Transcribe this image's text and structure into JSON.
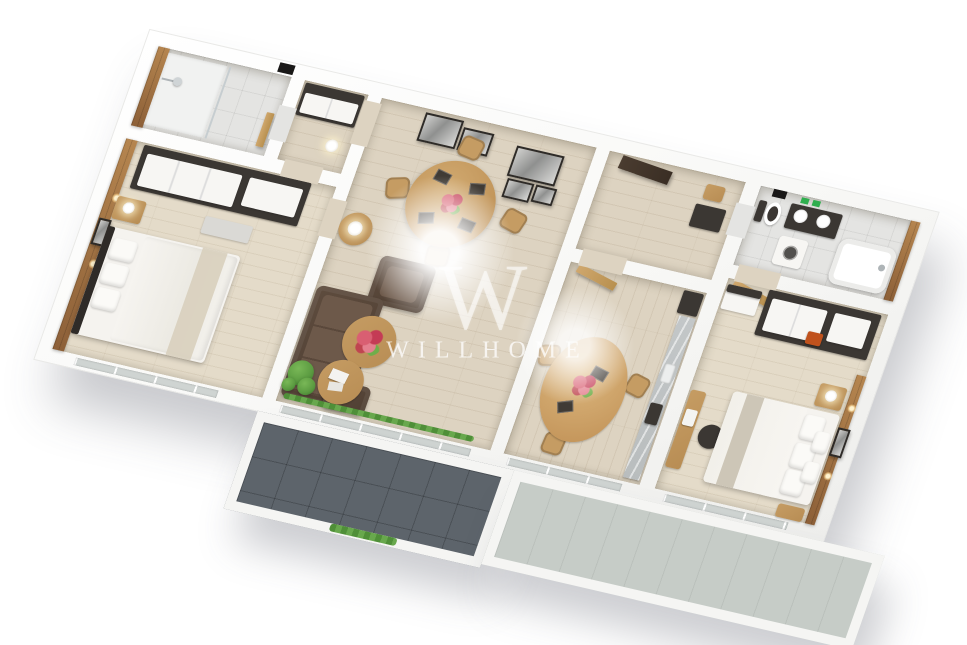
{
  "watermark": {
    "logo": "W",
    "text": "WILLHOME"
  },
  "colors": {
    "wall": "#ffffff",
    "floor_wood": "#ddd3c1",
    "floor_wood_light": "#e4dbc9",
    "floor_tile": "#e4e4e2",
    "balcony_dark": "#5d646b",
    "balcony_light": "#c6ccc7",
    "furniture_wood": "#c59c63",
    "dark_unit": "#3b3733",
    "sofa": "#5e4c3e",
    "bed": "#f5f3ef",
    "throw": "#d8cfbd",
    "plant": "#5a9a40",
    "flower": "#cf5168",
    "towel": "#2fae4e",
    "accent_orange": "#c0521d",
    "counter": "#b9bdbe",
    "door_wood": "#cfa76d",
    "entry_door": "#4a3c30"
  }
}
